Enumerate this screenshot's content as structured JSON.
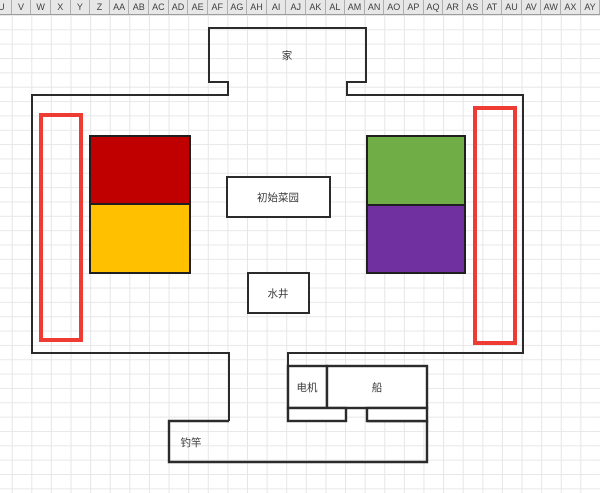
{
  "app": {
    "kind": "spreadsheet-with-drawing",
    "column_headers": [
      "U",
      "V",
      "W",
      "X",
      "Y",
      "Z",
      "AA",
      "AB",
      "AC",
      "AD",
      "AE",
      "AF",
      "AG",
      "AH",
      "AI",
      "AJ",
      "AK",
      "AL",
      "AM",
      "AN",
      "AO",
      "AP",
      "AQ",
      "AR",
      "AS",
      "AT",
      "AU",
      "AV",
      "AW",
      "AX",
      "AY"
    ]
  },
  "map": {
    "labels": {
      "home": "家",
      "garden": "初始菜园",
      "well": "水井",
      "motor": "电机",
      "boat": "船",
      "rod": "钓竿"
    },
    "colors": {
      "red_block": "#C00000",
      "yellow_block": "#FFC000",
      "green_block": "#70AD47",
      "purple_block": "#7030A0",
      "highlight_outline": "#EE3B33",
      "wall_outline": "#2b2b2b"
    }
  }
}
